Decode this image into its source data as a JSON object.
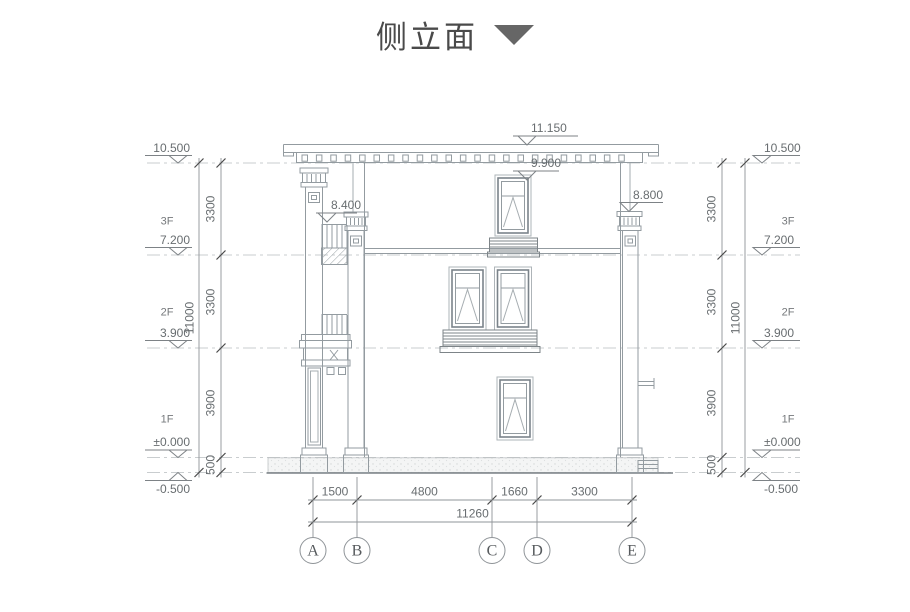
{
  "title": {
    "text": "侧立面"
  },
  "colors": {
    "line": "#939ba0",
    "dim_line": "#8f9498",
    "tick": "#4a4a4a",
    "symbol": "#7d8286",
    "text": "#686d70",
    "title": "#4a4a4a",
    "triangle": "#666666",
    "dash_line": "#c9cdcf"
  },
  "level_lines_y": [
    163,
    255,
    348,
    457.5,
    472.5
  ],
  "marker_geom": {
    "left": {
      "x1": 145,
      "x2": 192,
      "tri_cx": 178,
      "text_left": 145,
      "text_width": 45
    },
    "right": {
      "x1": 753,
      "x2": 800,
      "tri_cx": 762,
      "text_left": 764,
      "text_width": 60
    }
  },
  "levels": {
    "left": [
      {
        "label": "10.500",
        "y": 163
      },
      {
        "label": "7.200",
        "y": 255
      },
      {
        "label": "3.900",
        "y": 348
      },
      {
        "label": "±0.000",
        "y": 457.5
      },
      {
        "label": "-0.500",
        "y": 472.5,
        "below": true
      }
    ],
    "right": [
      {
        "label": "10.500",
        "y": 163
      },
      {
        "label": "7.200",
        "y": 255
      },
      {
        "label": "3.900",
        "y": 348
      },
      {
        "label": "±0.000",
        "y": 457.5
      },
      {
        "label": "-0.500",
        "y": 472.5,
        "below": true
      }
    ],
    "top": [
      {
        "label": "11.150",
        "apex_x": 527,
        "apex_y": 145,
        "line_x1": 513,
        "line_x2": 578
      },
      {
        "label": "9.900",
        "apex_x": 527,
        "apex_y": 180,
        "line_x1": 513,
        "line_x2": 559
      },
      {
        "label": "8.800",
        "apex_x": 629,
        "apex_y": 211.5,
        "line_x1": 620,
        "line_x2": 663
      },
      {
        "label": "8.400",
        "apex_x": 327,
        "apex_y": 222,
        "line_x1": 316,
        "line_x2": 357
      }
    ]
  },
  "floors": {
    "left_cx": 167,
    "right_cx": 788,
    "items": [
      {
        "label": "3F",
        "y": 222
      },
      {
        "label": "2F",
        "y": 313
      },
      {
        "label": "1F",
        "y": 420
      }
    ]
  },
  "vertical_dims": [
    {
      "x": 199,
      "text_x": 190,
      "segments": [
        {
          "label": "11000",
          "from": 163,
          "to": 472.5
        }
      ]
    },
    {
      "x": 221,
      "text_x": 211,
      "segments": [
        {
          "label": "3300",
          "from": 163,
          "to": 255
        },
        {
          "label": "3300",
          "from": 255,
          "to": 348
        },
        {
          "label": "3900",
          "from": 348,
          "to": 457.5
        },
        {
          "label": "500",
          "from": 457.5,
          "to": 472.5
        }
      ]
    },
    {
      "x": 722,
      "text_x": 712,
      "segments": [
        {
          "label": "3300",
          "from": 163,
          "to": 255
        },
        {
          "label": "3300",
          "from": 255,
          "to": 348
        },
        {
          "label": "3900",
          "from": 348,
          "to": 457.5
        },
        {
          "label": "500",
          "from": 457.5,
          "to": 472.5
        }
      ]
    },
    {
      "x": 745,
      "text_x": 736,
      "segments": [
        {
          "label": "11000",
          "from": 163,
          "to": 472.5
        }
      ]
    }
  ],
  "horizontal_dims": [
    {
      "y": 500,
      "segments": [
        {
          "label": "1500",
          "from": 313,
          "to": 357
        },
        {
          "label": "4800",
          "from": 357,
          "to": 492
        },
        {
          "label": "1660",
          "from": 492,
          "to": 537
        },
        {
          "label": "3300",
          "from": 537,
          "to": 632
        }
      ]
    },
    {
      "y": 522,
      "segments": [
        {
          "label": "11260",
          "from": 313,
          "to": 632
        }
      ]
    }
  ],
  "grid": {
    "line_top": 477,
    "line_bottom": 537,
    "bubble_cy": 550.5,
    "bubble_r": 13,
    "bubbles": [
      {
        "label": "A",
        "x": 313
      },
      {
        "label": "B",
        "x": 357
      },
      {
        "label": "C",
        "x": 492
      },
      {
        "label": "D",
        "x": 537
      },
      {
        "label": "E",
        "x": 632
      }
    ]
  }
}
